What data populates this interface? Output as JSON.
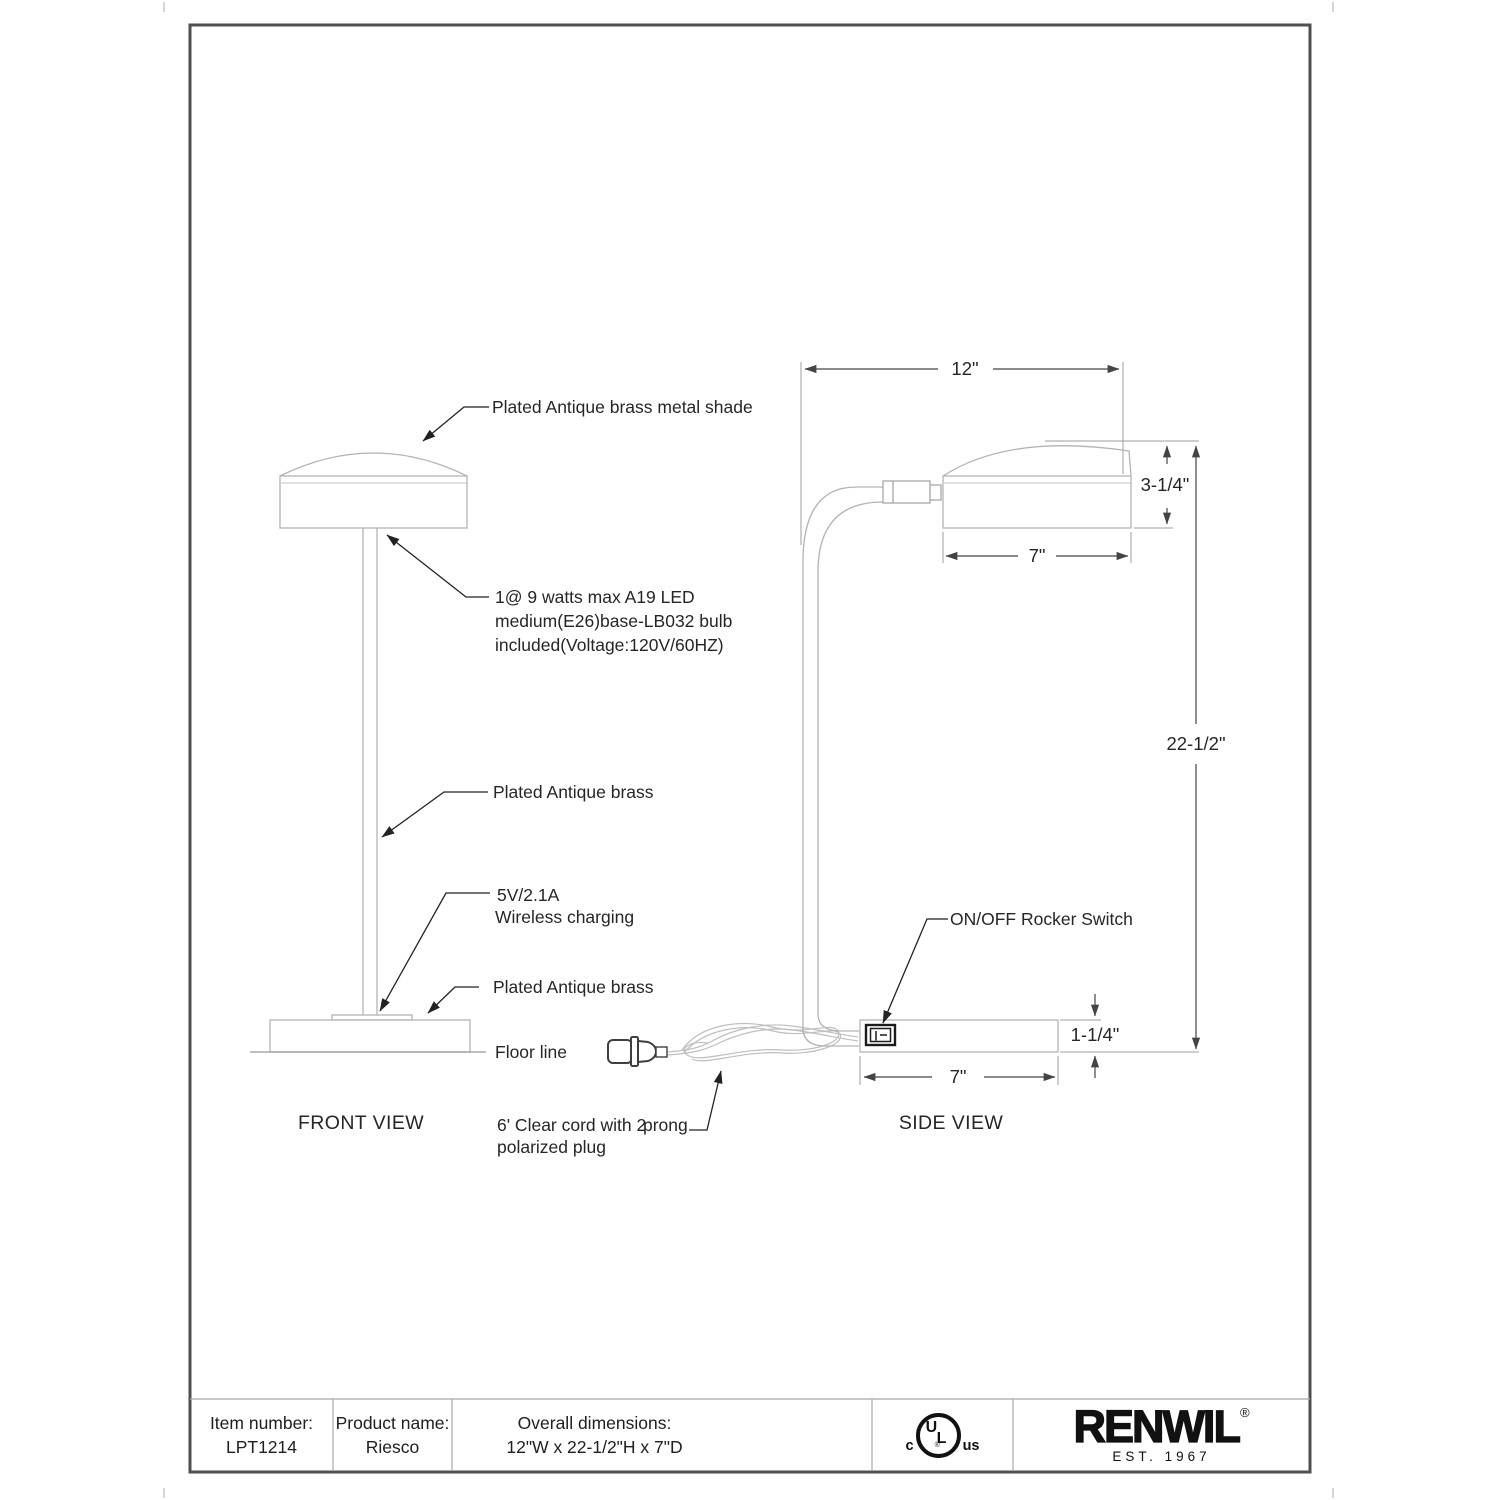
{
  "drawing": {
    "front_view_label": "FRONT VIEW",
    "side_view_label": "SIDE VIEW",
    "annotations": {
      "shade": "Plated Antique brass metal shade",
      "bulb1": "1@ 9 watts max A19 LED",
      "bulb2": "medium(E26)base-LB032 bulb",
      "bulb3": "included(Voltage:120V/60HZ)",
      "stem": "Plated Antique brass",
      "charging1": "5V/2.1A",
      "charging2": "Wireless charging",
      "base": "Plated Antique brass",
      "floor_line": "Floor line",
      "cord1a": "6' Clear cord with 2",
      "cord1b": "prong",
      "cord2": "polarized plug",
      "rocker_switch": "ON/OFF Rocker Switch"
    },
    "dimensions": {
      "overall_width": "12\"",
      "shade_height": "3-1/4\"",
      "shade_width": "7\"",
      "overall_height": "22-1/2\"",
      "base_height": "1-1/4\"",
      "base_width": "7\""
    }
  },
  "footer": {
    "item_number_label": "Item number:",
    "item_number_value": "LPT1214",
    "product_name_label": "Product name:",
    "product_name_value": "Riesco",
    "overall_dimensions_label": "Overall dimensions:",
    "overall_dimensions_value": "12\"W x 22-1/2\"H x 7\"D",
    "certification": {
      "left": "c",
      "monogram_u": "U",
      "monogram_l": "L",
      "registered": "®",
      "right": "us"
    },
    "brand": {
      "name": "RENWIL",
      "registered": "®",
      "established": "EST. 1967"
    }
  },
  "colors": {
    "background": "#ffffff",
    "page_border": "#4f4f4f",
    "lamp_outline": "#b3b3b3",
    "dimension_line": "#444444",
    "extension_line": "#9e9e9e",
    "leader_line": "#222222",
    "text": "#262626",
    "footer_divider": "#a8a8a8",
    "logo": "#111111"
  }
}
